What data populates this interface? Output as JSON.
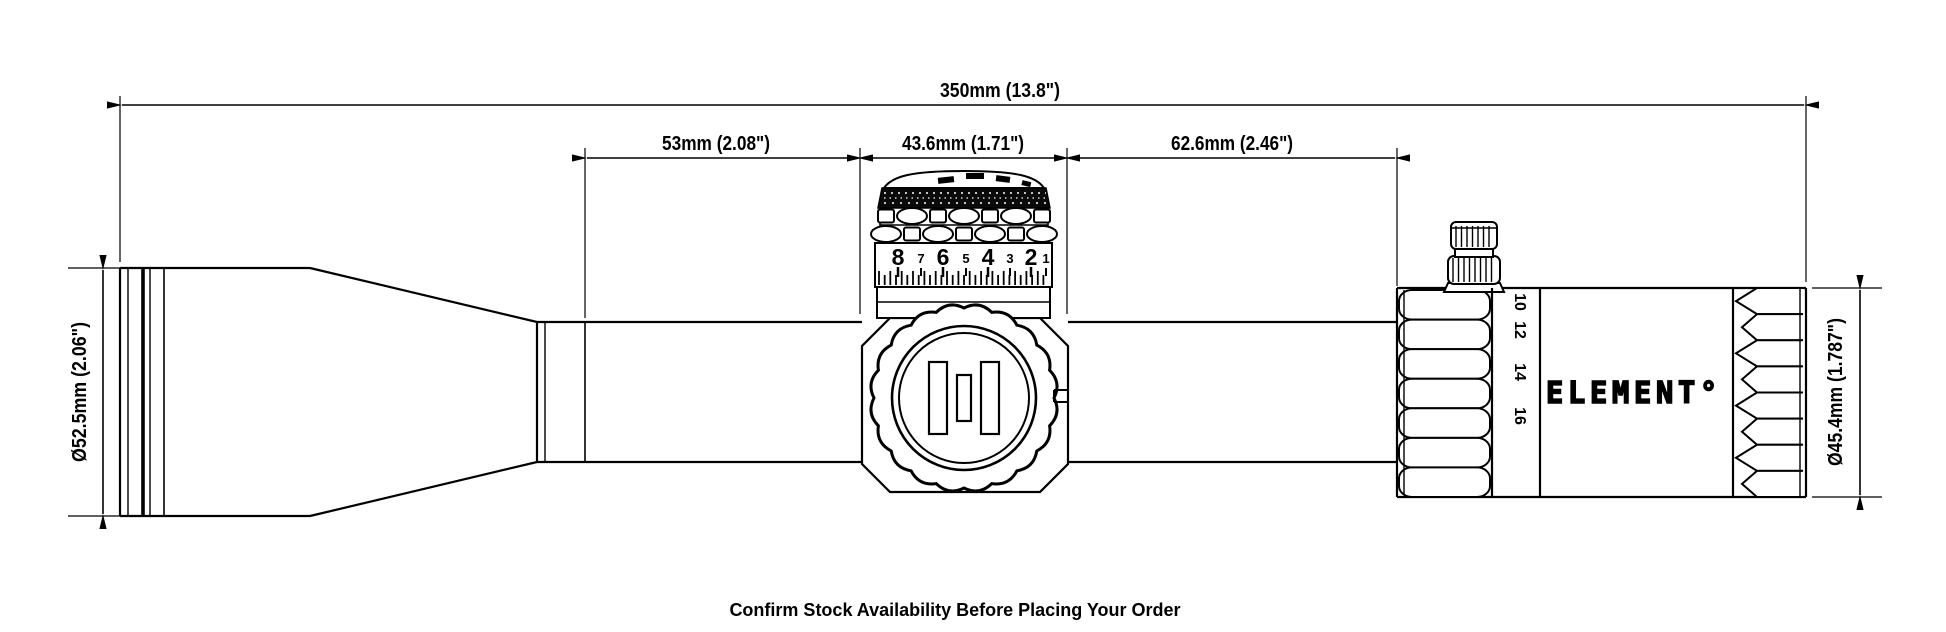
{
  "page": {
    "background": "#ffffff",
    "line_color": "#000000"
  },
  "footer": {
    "note": "Confirm Stock Availability Before Placing Your Order"
  },
  "brand": {
    "logo": "ELEMENT°"
  },
  "dimensions": {
    "overall_length": "350mm (13.8\")",
    "objective_to_turret": "53mm (2.08\")",
    "turret_saddle_width": "43.6mm (1.71\")",
    "turret_to_eyepiece": "62.6mm (2.46\")",
    "objective_bell_diameter": "Ø52.5mm (2.06\")",
    "eyepiece_diameter": "Ø45.4mm (1.787\")"
  },
  "elevation_turret": {
    "dial_numbers": [
      "8",
      "7",
      "6",
      "5",
      "4",
      "3",
      "2",
      "1"
    ]
  },
  "magnification_ring": {
    "numbers": [
      "10",
      "12",
      "14",
      "16"
    ]
  }
}
